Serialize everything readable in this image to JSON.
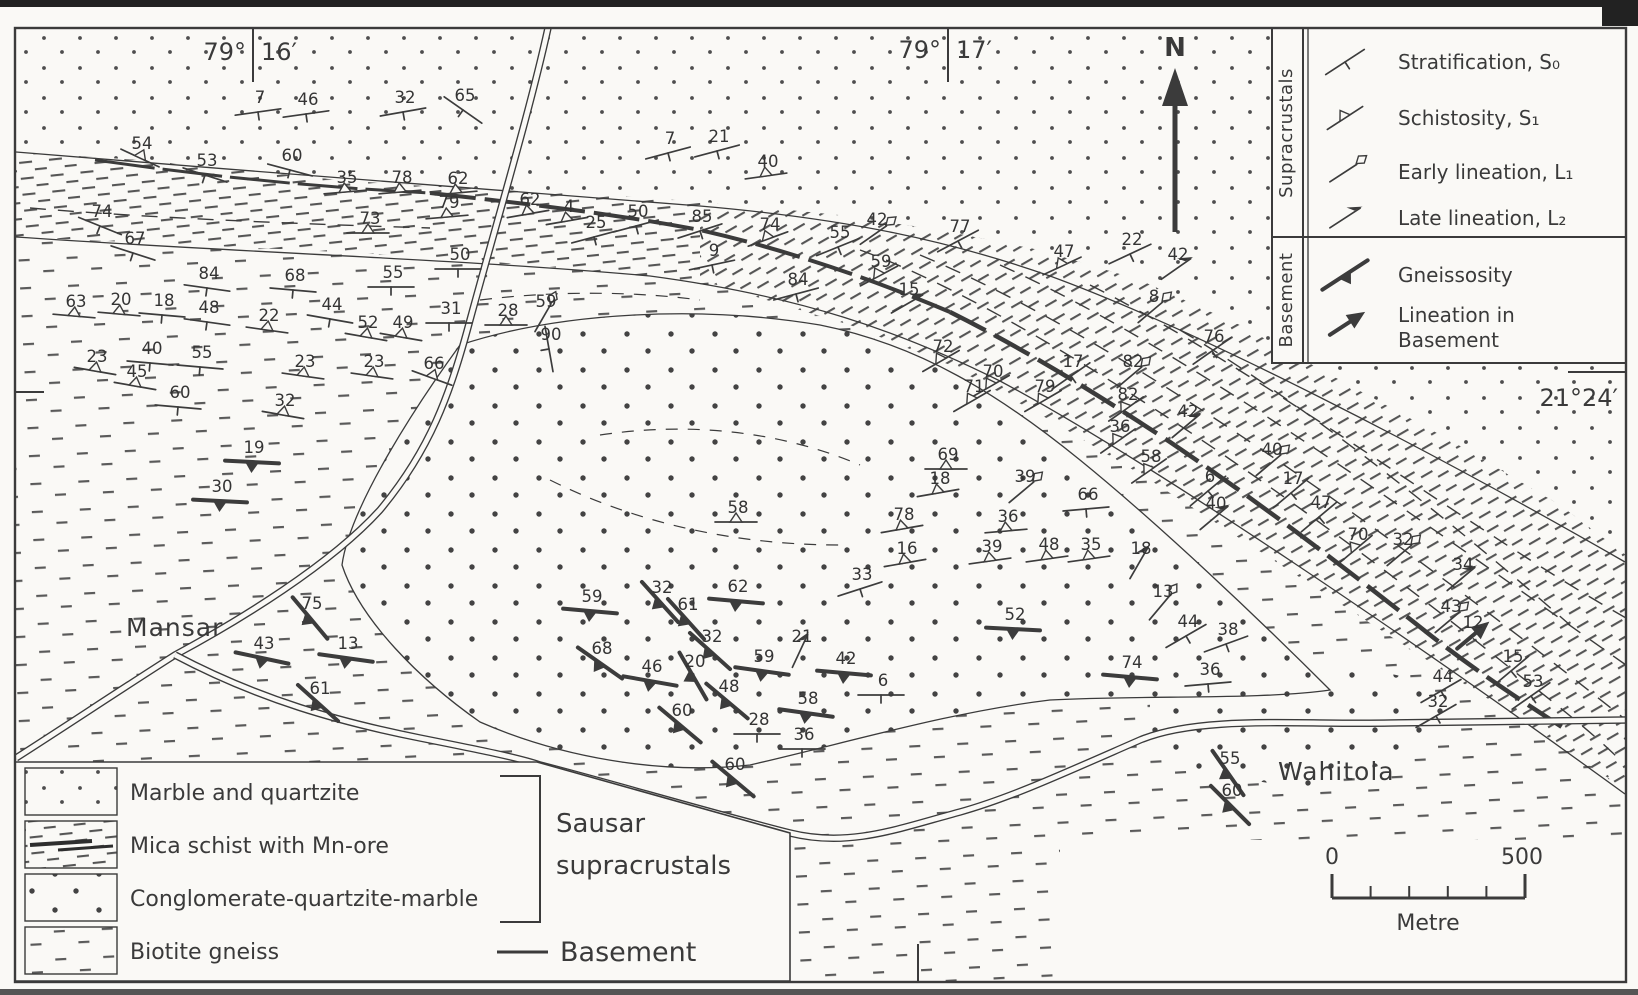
{
  "colors": {
    "paper": "#faf9f6",
    "ink": "#3b3b3b",
    "dot": "#4e4e4e",
    "scan_bar": "#222222"
  },
  "coordinates": {
    "tl_deg": "79°",
    "tl_min": "16′",
    "tc_deg": "79°",
    "tc_min": "17′",
    "right": "21°24′"
  },
  "north": {
    "label": "N"
  },
  "places": {
    "mansar": "Mansar",
    "wahitola": "Wahitola"
  },
  "structural_legend": {
    "groups": [
      {
        "label": "Supracrustals",
        "entries": [
          {
            "type": "strat",
            "icon": "stratification-icon",
            "label": "Stratification, S₀"
          },
          {
            "type": "schist",
            "icon": "schistosity-icon",
            "label": "Schistosity, S₁"
          },
          {
            "type": "elin",
            "icon": "early-lineation-icon",
            "label": "Early lineation, L₁"
          },
          {
            "type": "llin",
            "icon": "late-lineation-icon",
            "label": "Late lineation, L₂"
          }
        ]
      },
      {
        "label": "Basement",
        "entries": [
          {
            "type": "gneiss",
            "icon": "gneissosity-icon",
            "label": "Gneissosity"
          },
          {
            "type": "blin",
            "icon": "basement-lineation-icon",
            "label": "Lineation in",
            "label2": "Basement"
          }
        ]
      }
    ]
  },
  "lithology_legend": {
    "units": [
      {
        "pattern": "dots-fine",
        "label": "Marble and quartzite",
        "group": "Sausar supracrustals"
      },
      {
        "pattern": "schist-dash",
        "label": "Mica schist with Mn-ore",
        "group": "Sausar supracrustals"
      },
      {
        "pattern": "dots-coarse",
        "label": "Conglomerate-quartzite-marble",
        "group": "Sausar supracrustals"
      },
      {
        "pattern": "dash-sparse",
        "label": "Biotite gneiss",
        "group": "Basement"
      }
    ],
    "group_labels": {
      "sausar_line1": "Sausar",
      "sausar_line2": "supracrustals",
      "basement": "Basement"
    }
  },
  "scale_bar": {
    "start": "0",
    "end": "500",
    "unit": "Metre"
  },
  "measurements": [
    {
      "t": "strat",
      "v": "7",
      "x": 258,
      "y": 112,
      "r": -8
    },
    {
      "t": "strat",
      "v": "46",
      "x": 306,
      "y": 114,
      "r": -8
    },
    {
      "t": "strat",
      "v": "32",
      "x": 403,
      "y": 112,
      "r": -10
    },
    {
      "t": "strat",
      "v": "65",
      "x": 463,
      "y": 110,
      "r": 35
    },
    {
      "t": "schist",
      "v": "54",
      "x": 140,
      "y": 158,
      "r": 25
    },
    {
      "t": "strat",
      "v": "53",
      "x": 205,
      "y": 175,
      "r": 18
    },
    {
      "t": "strat",
      "v": "60",
      "x": 290,
      "y": 170,
      "r": 15
    },
    {
      "t": "strat",
      "v": "74",
      "x": 100,
      "y": 226,
      "r": 22
    },
    {
      "t": "strat",
      "v": "67",
      "x": 133,
      "y": 253,
      "r": 18
    },
    {
      "t": "schist",
      "v": "35",
      "x": 345,
      "y": 192,
      "r": -5
    },
    {
      "t": "schist",
      "v": "78",
      "x": 400,
      "y": 192,
      "r": -5
    },
    {
      "t": "schist",
      "v": "62",
      "x": 456,
      "y": 193,
      "r": -5
    },
    {
      "t": "schist",
      "v": "79",
      "x": 447,
      "y": 217,
      "r": -5
    },
    {
      "t": "schist",
      "v": "62",
      "x": 528,
      "y": 214,
      "r": -10
    },
    {
      "t": "schist",
      "v": "4",
      "x": 567,
      "y": 221,
      "r": -10
    },
    {
      "t": "schist",
      "v": "73",
      "x": 368,
      "y": 233,
      "r": 0
    },
    {
      "t": "strat",
      "v": "25",
      "x": 594,
      "y": 237,
      "r": -15
    },
    {
      "t": "strat",
      "v": "50",
      "x": 636,
      "y": 226,
      "r": -15
    },
    {
      "t": "strat",
      "v": "85",
      "x": 700,
      "y": 231,
      "r": -18
    },
    {
      "t": "schist",
      "v": "74",
      "x": 768,
      "y": 239,
      "r": -20
    },
    {
      "t": "strat",
      "v": "55",
      "x": 838,
      "y": 247,
      "r": -22
    },
    {
      "t": "elin",
      "v": "42",
      "x": 875,
      "y": 234,
      "r": -35
    },
    {
      "t": "strat",
      "v": "9",
      "x": 712,
      "y": 265,
      "r": -12
    },
    {
      "t": "schist",
      "v": "59",
      "x": 879,
      "y": 276,
      "r": -28
    },
    {
      "t": "llin",
      "v": "15",
      "x": 907,
      "y": 304,
      "r": -30
    },
    {
      "t": "strat",
      "v": "84",
      "x": 796,
      "y": 294,
      "r": -15
    },
    {
      "t": "strat",
      "v": "7",
      "x": 668,
      "y": 153,
      "r": -15
    },
    {
      "t": "strat",
      "v": "21",
      "x": 717,
      "y": 151,
      "r": -15
    },
    {
      "t": "schist",
      "v": "40",
      "x": 766,
      "y": 176,
      "r": -8
    },
    {
      "t": "strat",
      "v": "77",
      "x": 958,
      "y": 241,
      "r": -28
    },
    {
      "t": "schist",
      "v": "47",
      "x": 1062,
      "y": 266,
      "r": -25
    },
    {
      "t": "strat",
      "v": "22",
      "x": 1130,
      "y": 254,
      "r": -25
    },
    {
      "t": "llin",
      "v": "42",
      "x": 1176,
      "y": 269,
      "r": -35
    },
    {
      "t": "elin",
      "v": "8",
      "x": 1152,
      "y": 311,
      "r": -40
    },
    {
      "t": "strat",
      "v": "76",
      "x": 1212,
      "y": 351,
      "r": -35
    },
    {
      "t": "strat",
      "v": "84",
      "x": 207,
      "y": 288,
      "r": 8
    },
    {
      "t": "strat",
      "v": "68",
      "x": 293,
      "y": 290,
      "r": 5
    },
    {
      "t": "strat",
      "v": "55",
      "x": 391,
      "y": 287,
      "r": 0
    },
    {
      "t": "strat",
      "v": "50",
      "x": 458,
      "y": 269,
      "r": 0
    },
    {
      "t": "schist",
      "v": "63",
      "x": 74,
      "y": 316,
      "r": 5
    },
    {
      "t": "schist",
      "v": "20",
      "x": 119,
      "y": 314,
      "r": 5
    },
    {
      "t": "strat",
      "v": "18",
      "x": 162,
      "y": 315,
      "r": 5
    },
    {
      "t": "strat",
      "v": "48",
      "x": 207,
      "y": 322,
      "r": 8
    },
    {
      "t": "schist",
      "v": "22",
      "x": 267,
      "y": 330,
      "r": 8
    },
    {
      "t": "strat",
      "v": "44",
      "x": 330,
      "y": 319,
      "r": 10
    },
    {
      "t": "schist",
      "v": "52",
      "x": 366,
      "y": 337,
      "r": 10
    },
    {
      "t": "schist",
      "v": "49",
      "x": 401,
      "y": 337,
      "r": 10
    },
    {
      "t": "strat",
      "v": "31",
      "x": 449,
      "y": 323,
      "r": 0
    },
    {
      "t": "schist",
      "v": "28",
      "x": 506,
      "y": 325,
      "r": 0
    },
    {
      "t": "elin",
      "v": "59",
      "x": 544,
      "y": 316,
      "r": -60
    },
    {
      "t": "strat",
      "v": "90",
      "x": 549,
      "y": 349,
      "r": 80
    },
    {
      "t": "schist",
      "v": "23",
      "x": 95,
      "y": 371,
      "r": 10
    },
    {
      "t": "strat",
      "v": "40",
      "x": 150,
      "y": 363,
      "r": 5
    },
    {
      "t": "strat",
      "v": "55",
      "x": 200,
      "y": 367,
      "r": 5
    },
    {
      "t": "schist",
      "v": "45",
      "x": 135,
      "y": 386,
      "r": 10
    },
    {
      "t": "strat",
      "v": "60",
      "x": 178,
      "y": 407,
      "r": 5
    },
    {
      "t": "schist",
      "v": "23",
      "x": 303,
      "y": 376,
      "r": 8
    },
    {
      "t": "schist",
      "v": "23",
      "x": 372,
      "y": 376,
      "r": 8
    },
    {
      "t": "schist",
      "v": "66",
      "x": 432,
      "y": 378,
      "r": 20
    },
    {
      "t": "schist",
      "v": "32",
      "x": 283,
      "y": 415,
      "r": 10
    },
    {
      "t": "gneiss",
      "v": "19",
      "x": 252,
      "y": 462,
      "r": 3
    },
    {
      "t": "gneiss",
      "v": "30",
      "x": 220,
      "y": 501,
      "r": 3
    },
    {
      "t": "gneiss",
      "v": "75",
      "x": 310,
      "y": 618,
      "r": 50
    },
    {
      "t": "gneiss",
      "v": "43",
      "x": 262,
      "y": 658,
      "r": 12
    },
    {
      "t": "gneiss",
      "v": "13",
      "x": 346,
      "y": 658,
      "r": 8
    },
    {
      "t": "gneiss",
      "v": "61",
      "x": 318,
      "y": 703,
      "r": 42
    },
    {
      "t": "schist",
      "v": "58",
      "x": 736,
      "y": 522,
      "r": 0
    },
    {
      "t": "gneiss",
      "v": "59",
      "x": 590,
      "y": 611,
      "r": 5
    },
    {
      "t": "gneiss",
      "v": "32",
      "x": 660,
      "y": 602,
      "r": 48
    },
    {
      "t": "gneiss",
      "v": "61",
      "x": 686,
      "y": 619,
      "r": 48
    },
    {
      "t": "gneiss",
      "v": "62",
      "x": 736,
      "y": 601,
      "r": 5
    },
    {
      "t": "gneiss",
      "v": "32",
      "x": 710,
      "y": 651,
      "r": 42
    },
    {
      "t": "llin",
      "v": "21",
      "x": 800,
      "y": 651,
      "r": -65
    },
    {
      "t": "gneiss",
      "v": "59",
      "x": 762,
      "y": 671,
      "r": 8
    },
    {
      "t": "gneiss",
      "v": "68",
      "x": 600,
      "y": 663,
      "r": 35
    },
    {
      "t": "gneiss",
      "v": "46",
      "x": 650,
      "y": 681,
      "r": 10
    },
    {
      "t": "gneiss",
      "v": "20",
      "x": 693,
      "y": 676,
      "r": 60
    },
    {
      "t": "gneiss",
      "v": "48",
      "x": 727,
      "y": 701,
      "r": 40
    },
    {
      "t": "gneiss",
      "v": "58",
      "x": 806,
      "y": 713,
      "r": 8
    },
    {
      "t": "gneiss",
      "v": "42",
      "x": 844,
      "y": 673,
      "r": 5
    },
    {
      "t": "strat",
      "v": "6",
      "x": 881,
      "y": 695,
      "r": 0
    },
    {
      "t": "gneiss",
      "v": "60",
      "x": 680,
      "y": 725,
      "r": 40
    },
    {
      "t": "strat",
      "v": "28",
      "x": 757,
      "y": 734,
      "r": 0
    },
    {
      "t": "strat",
      "v": "36",
      "x": 802,
      "y": 749,
      "r": 0
    },
    {
      "t": "gneiss",
      "v": "60",
      "x": 733,
      "y": 779,
      "r": 40
    },
    {
      "t": "strat",
      "v": "33",
      "x": 860,
      "y": 589,
      "r": -18
    },
    {
      "t": "schist",
      "v": "72",
      "x": 941,
      "y": 361,
      "r": -30
    },
    {
      "t": "schist",
      "v": "70",
      "x": 991,
      "y": 386,
      "r": -30
    },
    {
      "t": "schist",
      "v": "71",
      "x": 972,
      "y": 401,
      "r": -30
    },
    {
      "t": "schist",
      "v": "79",
      "x": 1043,
      "y": 401,
      "r": -30
    },
    {
      "t": "strat",
      "v": "17",
      "x": 1071,
      "y": 376,
      "r": -35
    },
    {
      "t": "elin",
      "v": "82",
      "x": 1131,
      "y": 376,
      "r": -40
    },
    {
      "t": "schist",
      "v": "82",
      "x": 1126,
      "y": 409,
      "r": -35
    },
    {
      "t": "schist",
      "v": "36",
      "x": 1118,
      "y": 441,
      "r": -35
    },
    {
      "t": "llin",
      "v": "42",
      "x": 1186,
      "y": 426,
      "r": -40
    },
    {
      "t": "strat",
      "v": "6",
      "x": 1208,
      "y": 491,
      "r": -40
    },
    {
      "t": "schist",
      "v": "58",
      "x": 1149,
      "y": 471,
      "r": -35
    },
    {
      "t": "schist",
      "v": "69",
      "x": 946,
      "y": 469,
      "r": 0
    },
    {
      "t": "elin",
      "v": "39",
      "x": 1023,
      "y": 491,
      "r": -40
    },
    {
      "t": "strat",
      "v": "66",
      "x": 1086,
      "y": 509,
      "r": -5
    },
    {
      "t": "schist",
      "v": "18",
      "x": 938,
      "y": 493,
      "r": -10
    },
    {
      "t": "schist",
      "v": "78",
      "x": 902,
      "y": 529,
      "r": -10
    },
    {
      "t": "schist",
      "v": "16",
      "x": 905,
      "y": 563,
      "r": -10
    },
    {
      "t": "schist",
      "v": "36",
      "x": 1006,
      "y": 531,
      "r": -5
    },
    {
      "t": "schist",
      "v": "39",
      "x": 990,
      "y": 561,
      "r": -8
    },
    {
      "t": "schist",
      "v": "48",
      "x": 1047,
      "y": 559,
      "r": -8
    },
    {
      "t": "schist",
      "v": "35",
      "x": 1089,
      "y": 559,
      "r": -8
    },
    {
      "t": "llin",
      "v": "18",
      "x": 1139,
      "y": 563,
      "r": -60
    },
    {
      "t": "gneiss",
      "v": "52",
      "x": 1013,
      "y": 629,
      "r": 3
    },
    {
      "t": "elin",
      "v": "13",
      "x": 1161,
      "y": 606,
      "r": -50
    },
    {
      "t": "strat",
      "v": "44",
      "x": 1186,
      "y": 636,
      "r": -30
    },
    {
      "t": "strat",
      "v": "38",
      "x": 1226,
      "y": 644,
      "r": -20
    },
    {
      "t": "gneiss",
      "v": "74",
      "x": 1130,
      "y": 677,
      "r": 5
    },
    {
      "t": "strat",
      "v": "36",
      "x": 1208,
      "y": 684,
      "r": -5
    },
    {
      "t": "llin",
      "v": "40",
      "x": 1214,
      "y": 518,
      "r": -40
    },
    {
      "t": "elin",
      "v": "40",
      "x": 1270,
      "y": 464,
      "r": -40
    },
    {
      "t": "strat",
      "v": "17",
      "x": 1291,
      "y": 493,
      "r": -40
    },
    {
      "t": "strat",
      "v": "47",
      "x": 1319,
      "y": 517,
      "r": -40
    },
    {
      "t": "schist",
      "v": "70",
      "x": 1356,
      "y": 549,
      "r": -40
    },
    {
      "t": "elin",
      "v": "32",
      "x": 1401,
      "y": 554,
      "r": -40
    },
    {
      "t": "llin",
      "v": "34",
      "x": 1461,
      "y": 579,
      "r": -40
    },
    {
      "t": "elin",
      "v": "43",
      "x": 1449,
      "y": 621,
      "r": -40
    },
    {
      "t": "blin",
      "v": "12",
      "x": 1471,
      "y": 637,
      "r": -40
    },
    {
      "t": "strat",
      "v": "15",
      "x": 1511,
      "y": 671,
      "r": -40
    },
    {
      "t": "strat",
      "v": "44",
      "x": 1441,
      "y": 691,
      "r": -30
    },
    {
      "t": "strat",
      "v": "53",
      "x": 1531,
      "y": 696,
      "r": -35
    },
    {
      "t": "strat",
      "v": "32",
      "x": 1436,
      "y": 716,
      "r": -30
    },
    {
      "t": "gneiss",
      "v": "55",
      "x": 1228,
      "y": 773,
      "r": 55
    },
    {
      "t": "gneiss",
      "v": "60",
      "x": 1230,
      "y": 805,
      "r": 45
    }
  ]
}
